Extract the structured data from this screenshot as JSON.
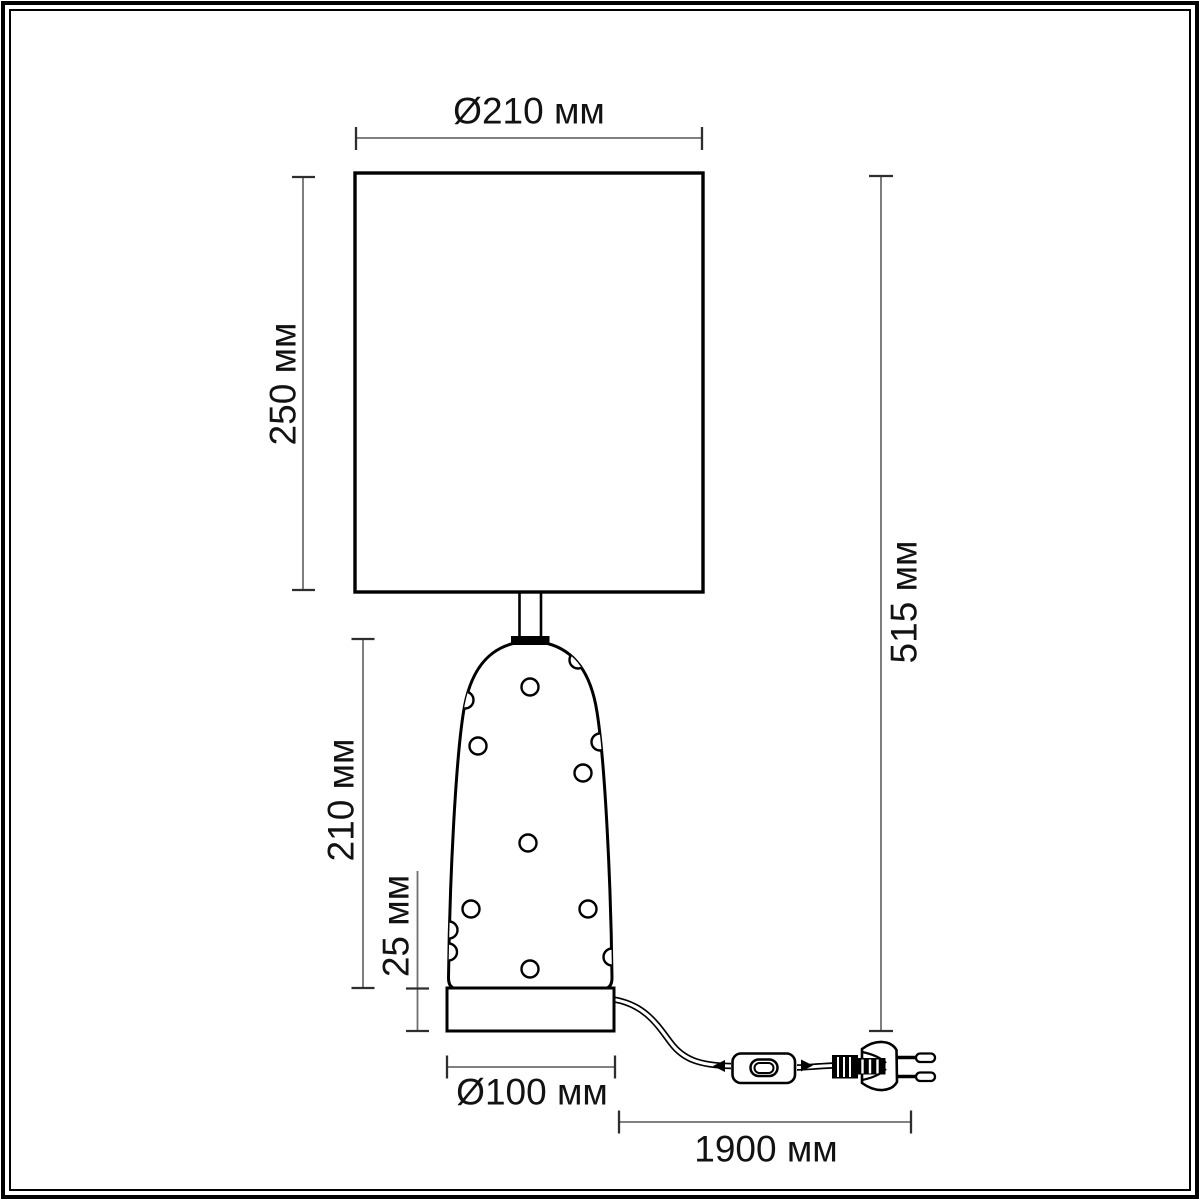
{
  "drawing": {
    "subject": "table-lamp-dimension-diagram",
    "parts": [
      "lampshade",
      "neck",
      "collar",
      "body",
      "decorative-dots",
      "base",
      "power-cord",
      "inline-switch",
      "power-plug"
    ]
  },
  "labels": {
    "shade_diameter": "Ø210 мм",
    "shade_height": "250 мм",
    "overall_height": "515 мм",
    "body_height": "210 мм",
    "base_height": "25 мм",
    "base_diameter": "Ø100 мм",
    "cord_length": "1900 мм"
  },
  "units": "мм",
  "colors": {
    "ink": "#000000",
    "dim": "#6f6f6f",
    "tick": "#2e2e2e",
    "text": "#121212",
    "paper": "#ffffff"
  }
}
